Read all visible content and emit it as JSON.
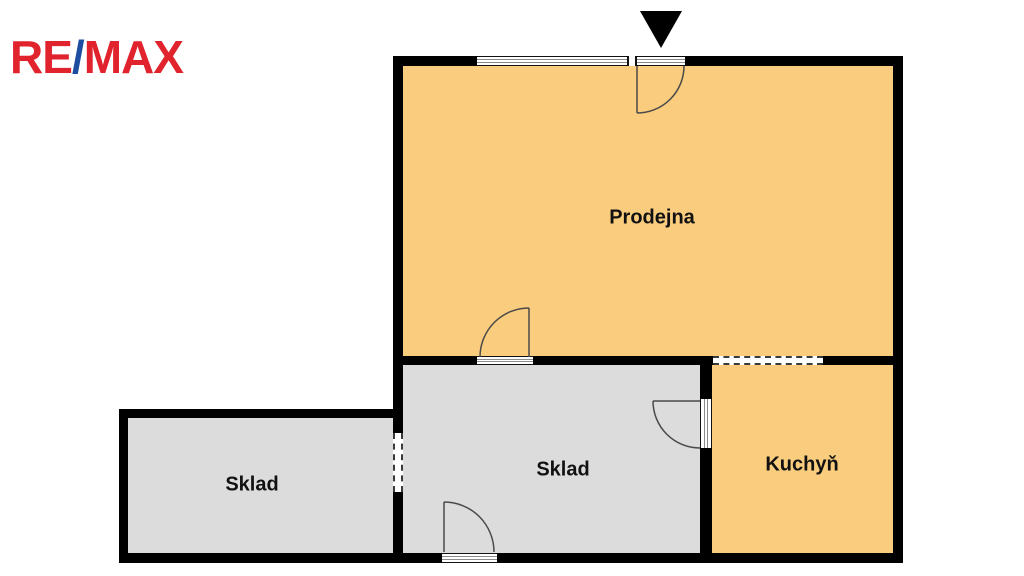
{
  "logo": {
    "re": "RE",
    "slash": "/",
    "max": "MAX"
  },
  "colors": {
    "logo_red": "#E1232E",
    "logo_blue": "#1C4DA1",
    "room_orange": "#FACC7E",
    "room_gray": "#DCDCDC",
    "wall_black": "#000000",
    "door_line": "#4a4a4a"
  },
  "rooms": [
    {
      "name": "prodejna",
      "label": "Prodejna"
    },
    {
      "name": "sklad-center",
      "label": "Sklad"
    },
    {
      "name": "sklad-left",
      "label": "Sklad"
    },
    {
      "name": "kuchyn",
      "label": "Kuchyň"
    }
  ],
  "icons": {
    "entrance_arrow": "triangle-down-icon",
    "window": "window-band",
    "door_swing": "quarter-circle-door-arc",
    "opening": "dashed-wall-opening"
  }
}
